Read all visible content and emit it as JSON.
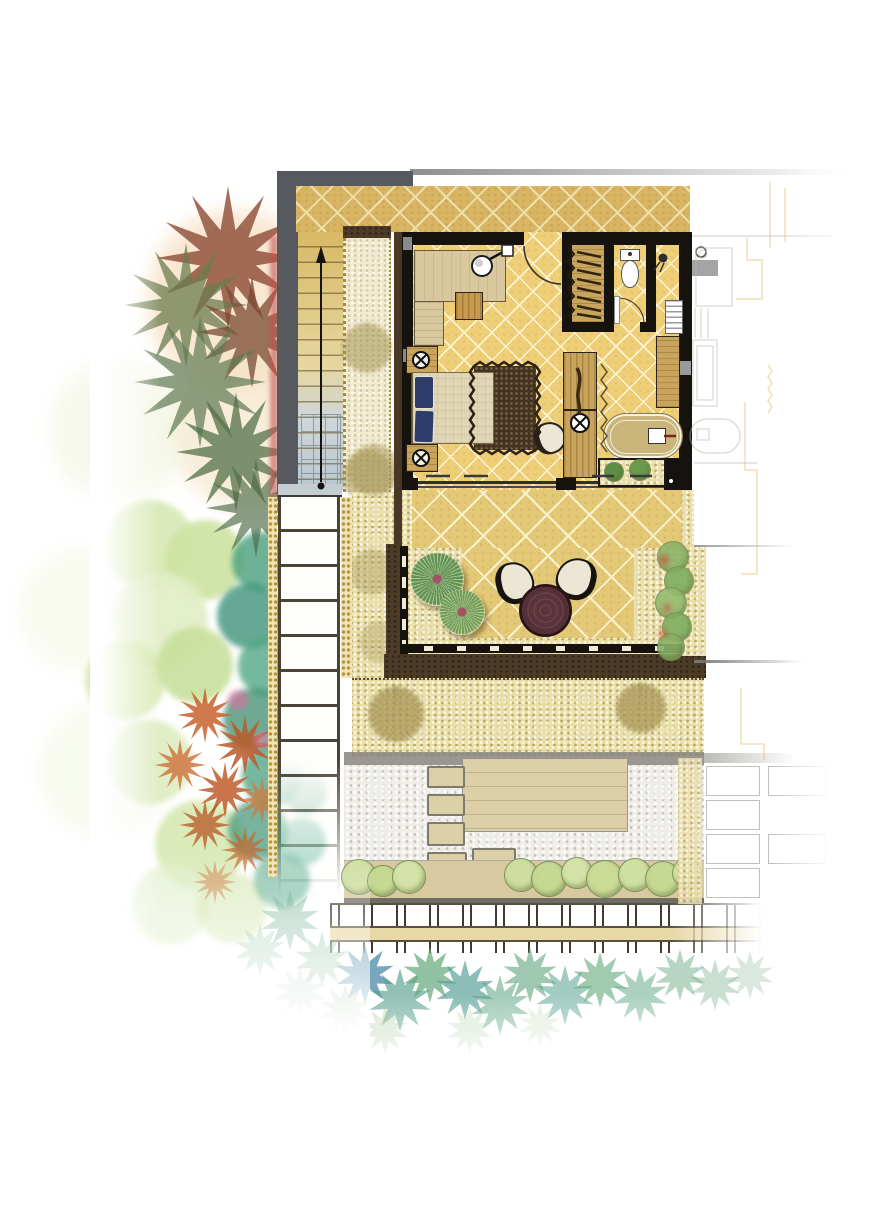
{
  "meta": {
    "type": "architectural-site-plan",
    "style": "watercolor-rendered villa floor plan, top view, no text labels",
    "orientation": "building centered, garden on left, neighbor unit faded on right"
  },
  "colors": {
    "frame-gray": "#56595d",
    "wall-black": "#16130f",
    "accent-red": "#c14f4f",
    "terrace-tile": "#d8b562",
    "terrace-line": "#efe0ab",
    "room-tile": "#eecf78",
    "room-line": "#fcf3d2",
    "lower-tile": "#e3c876",
    "lower-line": "#faf1cd",
    "gravel": "#eadfa9",
    "pebble": "#efede7",
    "stone-strip": "#f2ebd0",
    "border-brown": "#4d3b27",
    "deck-tan": "#dccfa5",
    "hedge-band": "#d8c9a0",
    "wood": "#c9a45c",
    "wood-dark": "#6b4a26",
    "sofa-tan": "#d9c79e",
    "mattress": "#e0d6b6",
    "pillow-navy": "#2d3c6a",
    "rug-brown": "#45331f",
    "tub-tan": "#c9b47a",
    "chair-cream": "#ece6d4",
    "table-maroon": "#4e2c34",
    "mat-black": "#15130f",
    "stair-tan": "#d8b966",
    "stair-blue": "#b9c7cf",
    "gray-band": "#8f8c84",
    "line-gray": "#6f6d66",
    "trellis-dark": "#403a30",
    "rail-tan": "#e8d8a6",
    "neighbor-line": "#b8b6b0",
    "neighbor-yellow": "#e3c06a",
    "gold-dot": "#b8912f",
    "plant-green": "#5e8f46",
    "fan-pink": "#a34b63",
    "path-white": "#fdfdfa",
    "path-line": "#4a4436"
  },
  "plan": {
    "areas": [
      "upper-entry-terrace",
      "staircase",
      "stone-border-strip",
      "bedroom",
      "wardrobe-closet",
      "wc",
      "shower",
      "bath-zone",
      "interior-planter",
      "lower-terrace",
      "gravel-walkway",
      "backyard-court",
      "timber-deck",
      "hedge-row",
      "trellis-fence",
      "side-garden",
      "neighbor-unit-outline"
    ],
    "furniture": [
      "l-shaped-sofa",
      "sofa-lamp",
      "coffee-table",
      "entry-door",
      "hanging-rail",
      "toilet",
      "shower-head",
      "louver-unit",
      "wall-bench",
      "double-bed",
      "navy-pillows",
      "nightstand-top",
      "nightstand-bottom",
      "bedside-lamps",
      "area-rug",
      "lounge-chair",
      "vanity-console",
      "wash-basin",
      "carved-decor",
      "bathtub",
      "tub-filler",
      "floor-mat",
      "terrace-chair-left",
      "terrace-chair-right",
      "round-terrace-table",
      "stepping-stones",
      "sliding-glass-doors",
      "up-arrow"
    ]
  },
  "garden": {
    "peach_wash": [
      {
        "x": 235,
        "y": 300,
        "r": 90,
        "c": "#f6ddbe",
        "o": 0.7
      },
      {
        "x": 250,
        "y": 430,
        "r": 80,
        "c": "#f3e2c2",
        "o": 0.6
      },
      {
        "x": 120,
        "y": 430,
        "r": 70,
        "c": "#eef3d8",
        "o": 0.5
      },
      {
        "x": 80,
        "y": 610,
        "r": 60,
        "c": "#f2f6e0",
        "o": 0.5
      },
      {
        "x": 105,
        "y": 770,
        "r": 65,
        "c": "#eef4da",
        "o": 0.45
      }
    ],
    "palm_canopies": [
      {
        "x": 228,
        "y": 258,
        "r": 72,
        "c": "#8d4c36",
        "o": 0.8
      },
      {
        "x": 186,
        "y": 305,
        "r": 62,
        "c": "#6b7c4f",
        "o": 0.75
      },
      {
        "x": 252,
        "y": 332,
        "r": 56,
        "c": "#7a4a33",
        "o": 0.75
      },
      {
        "x": 200,
        "y": 382,
        "r": 66,
        "c": "#5e7a52",
        "o": 0.7
      },
      {
        "x": 236,
        "y": 452,
        "r": 60,
        "c": "#55704a",
        "o": 0.75
      },
      {
        "x": 256,
        "y": 508,
        "r": 50,
        "c": "#4c6a45",
        "o": 0.65
      }
    ],
    "green_trees": [
      {
        "x": 150,
        "y": 545,
        "r": 45,
        "c": "#d8e8b4",
        "o": 0.9
      },
      {
        "x": 205,
        "y": 560,
        "r": 40,
        "c": "#cde3a2",
        "o": 0.9
      },
      {
        "x": 160,
        "y": 620,
        "r": 48,
        "c": "#e2eec6",
        "o": 0.9
      },
      {
        "x": 125,
        "y": 680,
        "r": 40,
        "c": "#d5e7ae",
        "o": 0.85
      },
      {
        "x": 195,
        "y": 665,
        "r": 38,
        "c": "#c8e09c",
        "o": 0.9
      },
      {
        "x": 150,
        "y": 762,
        "r": 42,
        "c": "#dcebbe",
        "o": 0.85
      },
      {
        "x": 200,
        "y": 845,
        "r": 45,
        "c": "#d2e5a8",
        "o": 0.8
      },
      {
        "x": 170,
        "y": 905,
        "r": 40,
        "c": "#dfeec8",
        "o": 0.7
      },
      {
        "x": 232,
        "y": 908,
        "r": 35,
        "c": "#cfe3a6",
        "o": 0.6
      }
    ],
    "teal_shrubs": [
      {
        "x": 262,
        "y": 562,
        "r": 30,
        "c": "#49a07e",
        "o": 0.8
      },
      {
        "x": 250,
        "y": 616,
        "r": 33,
        "c": "#3f947a",
        "o": 0.8
      },
      {
        "x": 268,
        "y": 666,
        "r": 30,
        "c": "#52a886",
        "o": 0.8
      },
      {
        "x": 255,
        "y": 720,
        "r": 32,
        "c": "#3e8e6e",
        "o": 0.75
      },
      {
        "x": 272,
        "y": 776,
        "r": 30,
        "c": "#47a080",
        "o": 0.75
      },
      {
        "x": 258,
        "y": 830,
        "r": 30,
        "c": "#3f9474",
        "o": 0.7
      },
      {
        "x": 282,
        "y": 880,
        "r": 28,
        "c": "#4da383",
        "o": 0.6
      },
      {
        "x": 302,
        "y": 842,
        "r": 24,
        "c": "#59b194",
        "o": 0.55
      },
      {
        "x": 305,
        "y": 792,
        "r": 22,
        "c": "#4f9d7e",
        "o": 0.55
      }
    ],
    "orange_plants": [
      {
        "x": 205,
        "y": 715,
        "r": 28,
        "c": "#c7622e",
        "o": 0.85
      },
      {
        "x": 245,
        "y": 745,
        "r": 30,
        "c": "#bd5a28",
        "o": 0.85
      },
      {
        "x": 180,
        "y": 765,
        "r": 26,
        "c": "#cf7038",
        "o": 0.8
      },
      {
        "x": 225,
        "y": 790,
        "r": 28,
        "c": "#c05c2a",
        "o": 0.85
      },
      {
        "x": 262,
        "y": 800,
        "r": 24,
        "c": "#d07a40",
        "o": 0.75
      },
      {
        "x": 205,
        "y": 825,
        "r": 26,
        "c": "#b85524",
        "o": 0.75
      },
      {
        "x": 245,
        "y": 850,
        "r": 24,
        "c": "#c66630",
        "o": 0.7
      },
      {
        "x": 215,
        "y": 882,
        "r": 22,
        "c": "#cf7a44",
        "o": 0.55
      }
    ],
    "pink_accents": [
      {
        "x": 238,
        "y": 700,
        "r": 10,
        "c": "#e06aa0",
        "o": 0.6
      },
      {
        "x": 262,
        "y": 740,
        "r": 8,
        "c": "#e87ab0",
        "o": 0.55
      },
      {
        "x": 300,
        "y": 640,
        "r": 8,
        "c": "#e87ab0",
        "o": 0.5
      }
    ],
    "stone_strip_trees": [
      {
        "x": 367,
        "y": 348,
        "r": 26,
        "c": "#b1a05c",
        "o": 0.55
      },
      {
        "x": 368,
        "y": 476,
        "r": 27,
        "c": "#b1a05c",
        "o": 0.5
      }
    ],
    "walkway_trees": [
      {
        "x": 374,
        "y": 470,
        "r": 27,
        "c": "#b1a05c",
        "o": 0.5
      },
      {
        "x": 372,
        "y": 572,
        "r": 24,
        "c": "#b1a05c",
        "o": 0.4
      },
      {
        "x": 380,
        "y": 642,
        "r": 22,
        "c": "#b1a05c",
        "o": 0.35
      },
      {
        "x": 396,
        "y": 714,
        "r": 29,
        "c": "#b1a05c",
        "o": 0.75
      },
      {
        "x": 641,
        "y": 708,
        "r": 26,
        "c": "#b1a05c",
        "o": 0.75
      }
    ],
    "terrace_fan_palms": [
      {
        "x": 437,
        "y": 579,
        "r": 27,
        "c": "#5d8f4c",
        "o": 0.95
      },
      {
        "x": 462,
        "y": 612,
        "r": 23,
        "c": "#6f9c53",
        "o": 0.95
      }
    ],
    "terrace_border_shrubs": [
      {
        "x": 672,
        "y": 556,
        "r": 15,
        "c": "#8cb468",
        "o": 0.9
      },
      {
        "x": 678,
        "y": 580,
        "r": 14,
        "c": "#7fae62",
        "o": 0.9
      },
      {
        "x": 670,
        "y": 602,
        "r": 15,
        "c": "#95bb70",
        "o": 0.9
      },
      {
        "x": 676,
        "y": 626,
        "r": 14,
        "c": "#7fae62",
        "o": 0.9
      },
      {
        "x": 670,
        "y": 646,
        "r": 13,
        "c": "#88b266",
        "o": 0.9
      }
    ],
    "terrace_border_red_dots": [
      {
        "x": 664,
        "y": 560,
        "r": 5,
        "c": "#c05a40",
        "o": 0.8
      },
      {
        "x": 667,
        "y": 608,
        "r": 4,
        "c": "#c05a40",
        "o": 0.8
      },
      {
        "x": 663,
        "y": 634,
        "r": 4,
        "c": "#c05a40",
        "o": 0.8
      }
    ],
    "planter_plants": [
      {
        "x": 613,
        "y": 471,
        "r": 9,
        "c": "#5e8f46",
        "o": 1
      },
      {
        "x": 639,
        "y": 469,
        "r": 10,
        "c": "#6a9a4e",
        "o": 1
      }
    ],
    "hedge_shrubs": [
      {
        "x": 358,
        "y": 876,
        "r": 17,
        "c": "#cfe0a0",
        "o": 0.95
      },
      {
        "x": 382,
        "y": 880,
        "r": 15,
        "c": "#c6da94",
        "o": 0.95
      },
      {
        "x": 408,
        "y": 876,
        "r": 16,
        "c": "#d4e4a8",
        "o": 0.95
      },
      {
        "x": 520,
        "y": 874,
        "r": 16,
        "c": "#cfe0a0",
        "o": 0.95
      },
      {
        "x": 548,
        "y": 878,
        "r": 17,
        "c": "#c6da94",
        "o": 0.95
      },
      {
        "x": 576,
        "y": 872,
        "r": 15,
        "c": "#d4e4a8",
        "o": 0.95
      },
      {
        "x": 604,
        "y": 878,
        "r": 18,
        "c": "#cadc98",
        "o": 0.95
      },
      {
        "x": 634,
        "y": 874,
        "r": 16,
        "c": "#d0e2a2",
        "o": 0.95
      },
      {
        "x": 662,
        "y": 878,
        "r": 17,
        "c": "#c6da94",
        "o": 0.9
      },
      {
        "x": 686,
        "y": 872,
        "r": 14,
        "c": "#d4e4a8",
        "o": 0.85
      }
    ],
    "court_trees": [
      {
        "x": 398,
        "y": 712,
        "r": 28,
        "c": "#b3a25c",
        "o": 0.8
      },
      {
        "x": 640,
        "y": 706,
        "r": 27,
        "c": "#b3a25c",
        "o": 0.8
      }
    ],
    "bottom_palmettos": [
      {
        "x": 365,
        "y": 975,
        "r": 30,
        "c": "#4a88a8",
        "o": 0.75
      },
      {
        "x": 400,
        "y": 1000,
        "r": 32,
        "c": "#57a08e",
        "o": 0.65
      },
      {
        "x": 430,
        "y": 975,
        "r": 28,
        "c": "#63a87a",
        "o": 0.7
      },
      {
        "x": 465,
        "y": 990,
        "r": 30,
        "c": "#4f9a90",
        "o": 0.65
      },
      {
        "x": 500,
        "y": 1005,
        "r": 30,
        "c": "#5aa382",
        "o": 0.55
      },
      {
        "x": 530,
        "y": 975,
        "r": 28,
        "c": "#6aab84",
        "o": 0.65
      },
      {
        "x": 565,
        "y": 995,
        "r": 30,
        "c": "#57a08e",
        "o": 0.55
      },
      {
        "x": 600,
        "y": 980,
        "r": 28,
        "c": "#63a87a",
        "o": 0.6
      },
      {
        "x": 640,
        "y": 995,
        "r": 28,
        "c": "#5aa382",
        "o": 0.5
      },
      {
        "x": 680,
        "y": 975,
        "r": 26,
        "c": "#6fae88",
        "o": 0.5
      },
      {
        "x": 715,
        "y": 985,
        "r": 26,
        "c": "#79b08e",
        "o": 0.4
      },
      {
        "x": 750,
        "y": 975,
        "r": 24,
        "c": "#84b494",
        "o": 0.3
      },
      {
        "x": 345,
        "y": 1010,
        "r": 26,
        "c": "#8bb47c",
        "o": 0.45
      },
      {
        "x": 385,
        "y": 1030,
        "r": 24,
        "c": "#97bd8a",
        "o": 0.35
      },
      {
        "x": 470,
        "y": 1030,
        "r": 24,
        "c": "#9dc292",
        "o": 0.3
      },
      {
        "x": 540,
        "y": 1025,
        "r": 22,
        "c": "#a2c696",
        "o": 0.25
      },
      {
        "x": 290,
        "y": 920,
        "r": 30,
        "c": "#5aa382",
        "o": 0.45
      },
      {
        "x": 322,
        "y": 960,
        "r": 28,
        "c": "#63a87a",
        "o": 0.4
      },
      {
        "x": 260,
        "y": 950,
        "r": 26,
        "c": "#6fae88",
        "o": 0.35
      },
      {
        "x": 300,
        "y": 992,
        "r": 26,
        "c": "#84b494",
        "o": 0.28
      }
    ]
  }
}
